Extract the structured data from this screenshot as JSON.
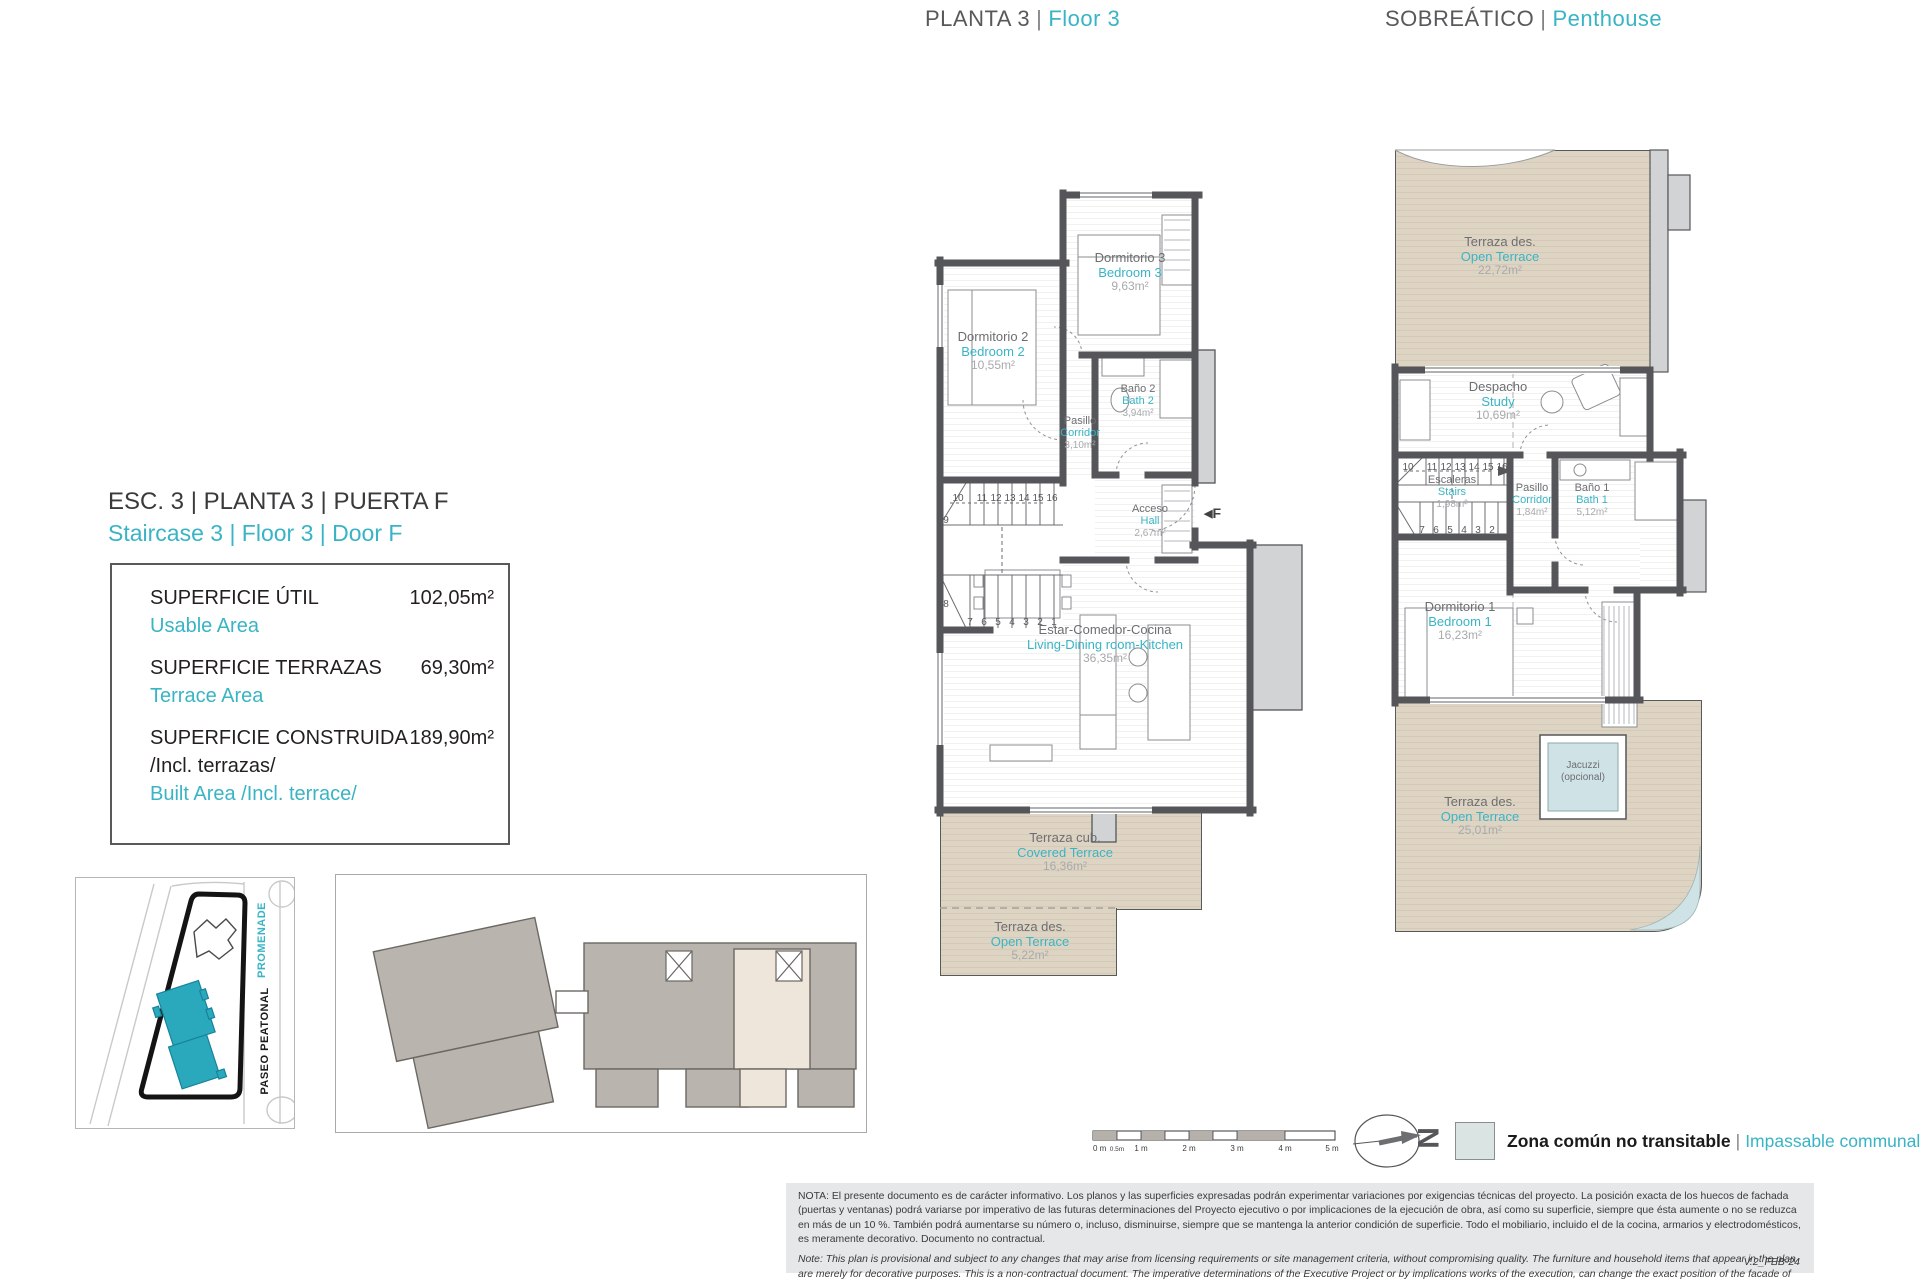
{
  "titles": {
    "plan3_es": "PLANTA 3",
    "plan3_en": "Floor 3",
    "penthouse_es": "SOBREÁTICO",
    "penthouse_en": "Penthouse",
    "sep": "|"
  },
  "unit": {
    "line_es": "ESC. 3 | PLANTA 3 | PUERTA F",
    "line_en": "Staircase 3 | Floor 3 | Door F"
  },
  "areas": {
    "util_label": "SUPERFICIE ÚTIL",
    "util_en": "Usable Area",
    "util_value": "102,05m²",
    "terr_label": "SUPERFICIE TERRAZAS",
    "terr_en": "Terrace Area",
    "terr_value": "69,30m²",
    "cons_label": "SUPERFICIE CONSTRUIDA",
    "cons_label2": "/Incl. terrazas/",
    "cons_en": "Built Area /Incl. terrace/",
    "cons_value": "189,90m²"
  },
  "site_plan": {
    "street_en": "PROMENADE",
    "street_es": "PASEO PEATONAL"
  },
  "plan3": {
    "rooms": [
      {
        "es": "Dormitorio 3",
        "en": "Bedroom 3",
        "area": "9,63m²"
      },
      {
        "es": "Dormitorio 2",
        "en": "Bedroom 2",
        "area": "10,55m²"
      },
      {
        "es": "Baño 2",
        "en": "Bath 2",
        "area": "3,94m²"
      },
      {
        "es": "Pasillo",
        "en": "Corridor",
        "area": "3,10m²"
      },
      {
        "es": "Acceso",
        "en": "Hall",
        "area": "2,67m²"
      },
      {
        "es": "Estar-Comedor-Cocina",
        "en": "Living-Dining room-Kitchen",
        "area": "36,35m²"
      },
      {
        "es": "Terraza cub.",
        "en": "Covered Terrace",
        "area": "16,36m²"
      },
      {
        "es": "Terraza des.",
        "en": "Open Terrace",
        "area": "5,22m²"
      }
    ],
    "door_marker": "F"
  },
  "penthouse": {
    "rooms": [
      {
        "es": "Terraza des.",
        "en": "Open Terrace",
        "area": "22,72m²"
      },
      {
        "es": "Despacho",
        "en": "Study",
        "area": "10,69m²"
      },
      {
        "es": "Escaleras",
        "en": "Stairs",
        "area": "1,98m²"
      },
      {
        "es": "Pasillo",
        "en": "Corridor",
        "area": "1,84m²"
      },
      {
        "es": "Baño 1",
        "en": "Bath 1",
        "area": "5,12m²"
      },
      {
        "es": "Dormitorio 1",
        "en": "Bedroom 1",
        "area": "16,23m²"
      },
      {
        "es": "Terraza des.",
        "en": "Open Terrace",
        "area": "25,01m²"
      }
    ],
    "jacuzzi_l1": "Jacuzzi",
    "jacuzzi_l2": "(opcional)"
  },
  "stair_numbers": {
    "n1": "1",
    "n2": "2",
    "n3": "3",
    "n4": "4",
    "n5": "5",
    "n6": "6",
    "n7": "7",
    "n8": "8",
    "n9": "9",
    "n10": "10",
    "n11": "11",
    "n12": "12",
    "n13": "13",
    "n14": "14",
    "n15": "15",
    "n16": "16"
  },
  "scale_bar": {
    "t0": "0 m",
    "t05": "0.5m",
    "t1": "1 m",
    "t2": "2 m",
    "t3": "3 m",
    "t4": "4 m",
    "t5": "5 m"
  },
  "north_letter": "N",
  "legend": {
    "es": "Zona común no transitable",
    "en": "Impassable communal area",
    "sep": "|"
  },
  "notes": {
    "es": "NOTA:  El presente documento es de carácter informativo. Los planos y las superficies expresadas podrán experimentar variaciones por exigencias técnicas del proyecto. La posición exacta de los huecos de fachada (puertas y ventanas) podrá variarse por imperativo de las futuras determinaciones del Proyecto ejecutivo o por implicaciones de la ejecución de obra, así como su superficie, siempre que ésta aumente o no se reduzca en más de un 10 %. También podrá aumentarse su número o, incluso, disminuirse, siempre que se mantenga la anterior condición de superficie. Todo el mobiliario, incluido el de la cocina, armarios y electrodomésticos, es meramente decorativo. Documento no contractual.",
    "en": "Note: This plan is provisional and subject to any changes that may arise from licensing requirements or site management criteria, without compromising quality. The furniture and household items that appear in the plan are merely for decorative purposes. This is a non-contractual document. The imperative determinations of the Executive Project or by implications works of the execution, can change the exact position of the facade of doors and windows, as well the surface area may also be increased or even decrease not more than a 10%.",
    "version": "V.2_FEB-24"
  },
  "colors": {
    "accent_teal": "#39b4c5",
    "wall_gray": "#55565a",
    "terrace_beige": "#ddd3c3",
    "communal_blue": "#d9e4e3"
  }
}
